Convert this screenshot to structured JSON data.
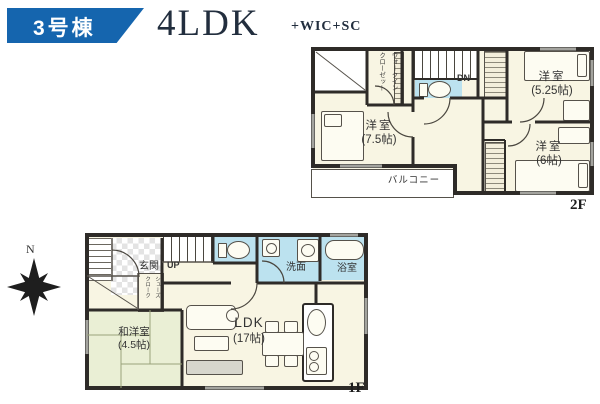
{
  "header": {
    "badge_label": "3号棟",
    "plan_type": "4LDK",
    "plan_suffix": "+WIC+SC"
  },
  "floor2": {
    "floor_label": "2F",
    "wic_line1": "ウォークイン",
    "wic_line2": "クローゼット",
    "stairs_label": "DN",
    "bedroom75_name": "洋室",
    "bedroom75_size": "(7.5帖)",
    "bedroom525_name": "洋室",
    "bedroom525_size": "(5.25帖)",
    "bedroom6_name": "洋室",
    "bedroom6_size": "(6帖)",
    "balcony_label": "バルコニー"
  },
  "floor1": {
    "floor_label": "1F",
    "compass_label": "N",
    "entrance_label": "玄関",
    "stairs_label": "UP",
    "washroom_label": "洗面",
    "bathroom_label": "浴室",
    "shoes_line1": "シューズ",
    "shoes_line2": "クローク",
    "japanese_room_name": "和洋室",
    "japanese_room_size": "(4.5帖)",
    "ldk_name": "LDK",
    "ldk_size": "(17帖)"
  },
  "colors": {
    "badge_blue": "#1565ae",
    "title_navy": "#222e3e",
    "room_cream": "#f8f5e3",
    "wet_area_blue": "#bce2ef",
    "tatami_green": "#eaefd5",
    "wall_dark": "#2e2b28"
  }
}
